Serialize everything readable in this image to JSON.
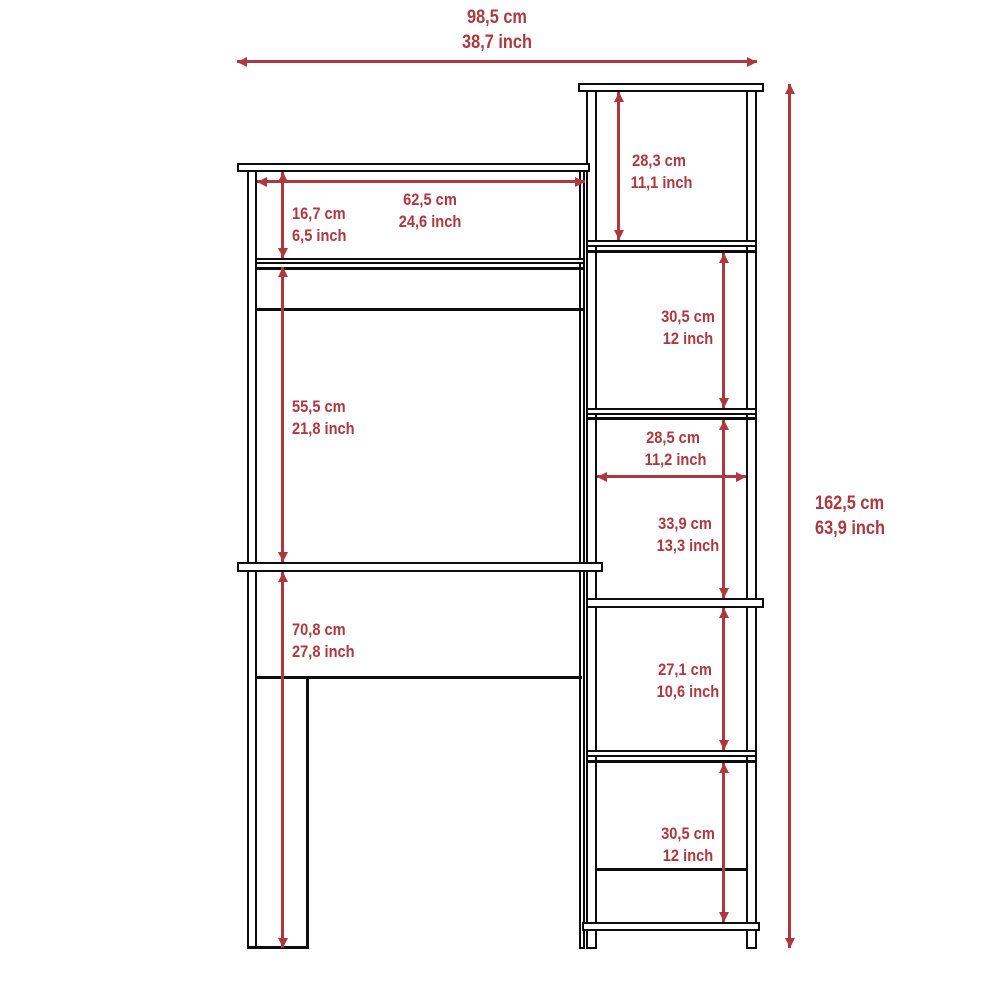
{
  "diagram": {
    "kind": "furniture-dimension-diagram",
    "accent_color": "#AD383F",
    "line_color": "#0d0d0d",
    "background_color": "#ffffff"
  },
  "dimensions": {
    "overall_width": {
      "cm": "98,5 cm",
      "inch": "38,7 inch"
    },
    "overall_height": {
      "cm": "162,5 cm",
      "inch": "63,9 inch"
    },
    "hutch_opening_width": {
      "cm": "62,5 cm",
      "inch": "24,6 inch"
    },
    "hutch_opening_height": {
      "cm": "16,7 cm",
      "inch": "6,5 inch"
    },
    "desk_clearance": {
      "cm": "55,5 cm",
      "inch": "21,8 inch"
    },
    "desk_height": {
      "cm": "70,8 cm",
      "inch": "27,8 inch"
    },
    "cubby1_height": {
      "cm": "28,3 cm",
      "inch": "11,1 inch"
    },
    "cubby2_height": {
      "cm": "30,5 cm",
      "inch": "12 inch"
    },
    "cubby_width": {
      "cm": "28,5 cm",
      "inch": "11,2 inch"
    },
    "cubby3_height": {
      "cm": "33,9 cm",
      "inch": "13,3 inch"
    },
    "cubby4_height": {
      "cm": "27,1 cm",
      "inch": "10,6 inch"
    },
    "cubby5_height": {
      "cm": "30,5 cm",
      "inch": "12 inch"
    }
  }
}
